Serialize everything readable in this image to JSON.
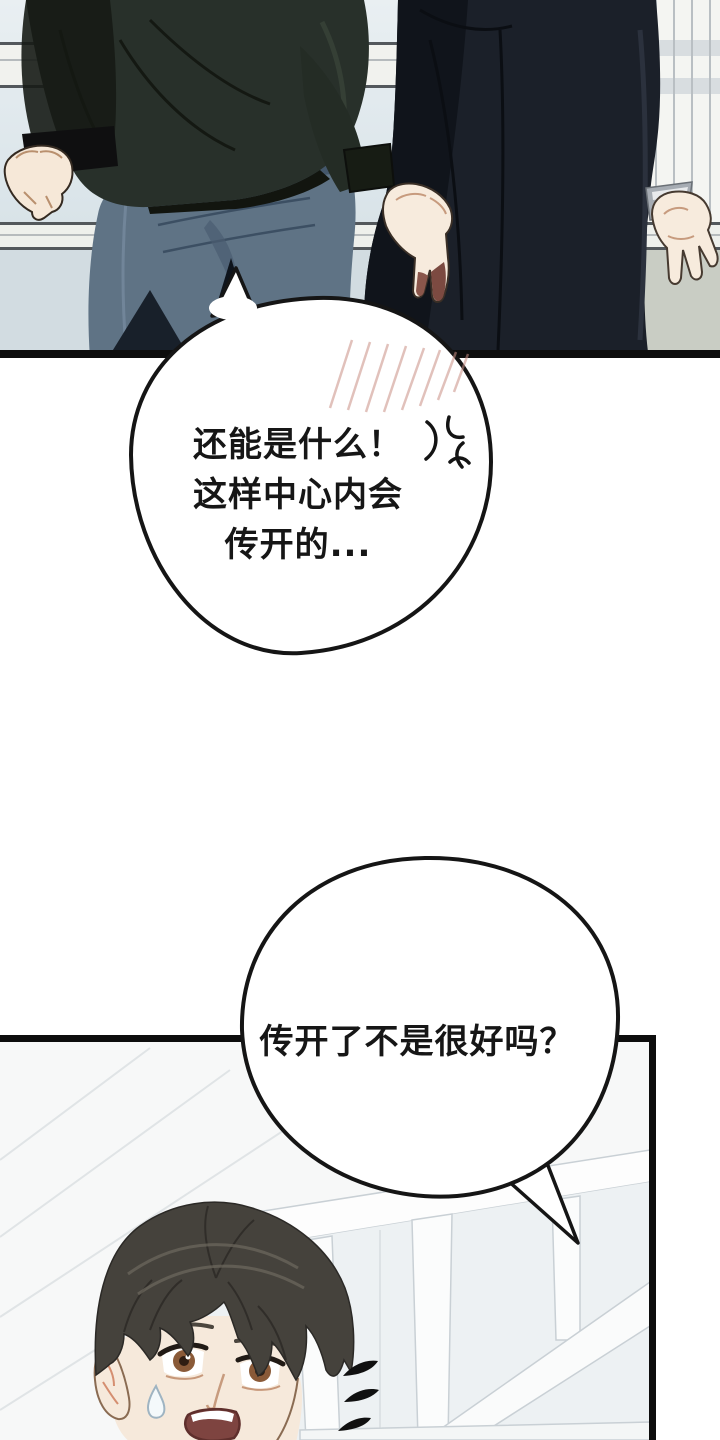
{
  "page": {
    "type": "webtoon comic page",
    "background": "#ffffff"
  },
  "panels": {
    "top": {
      "scene": "two figures walking away down a hallway, seen from behind",
      "figure_left": "person in dark green jacket and blue jeans, fist clenched",
      "figure_right": "person in long dark coat, hand hanging with stained fingertips"
    },
    "bottom": {
      "scene": "startled young man looking back in bright window hallway",
      "character": "dark brown hair, brown eyes, open mouth, sweat drop"
    }
  },
  "speech_bubbles": [
    {
      "id": "bubble-1",
      "lines": [
        "还能是什么！",
        "这样中心内会",
        "传开的..."
      ],
      "effects": [
        "anger-vein",
        "blush-hatching"
      ]
    },
    {
      "id": "bubble-2",
      "lines": [
        "传开了不是很好吗？"
      ],
      "effects": []
    }
  ],
  "effects": {
    "anger_vein_count": 1,
    "blush_hatch_lines": 8,
    "surprise_marks_count": 3,
    "sweat_drop_count": 1
  },
  "colors": {
    "panel_border": "#0d0d0d",
    "bubble_outline": "#151515",
    "bubble_fill": "#ffffff",
    "wall_light": "#e7eef1",
    "wall_mid": "#d4dfe4",
    "molding": "#f1f2ee",
    "jacket_green": "#28302a",
    "coat_dark": "#1b2029",
    "jeans_blue": "#5f7385",
    "skin": "#f6e8d8",
    "finger_stain": "#7c4a41",
    "hair": "#45423c",
    "iris_brown": "#8a5a38",
    "glass": "#edf1f3",
    "blush_hatch": "#c98f85"
  }
}
